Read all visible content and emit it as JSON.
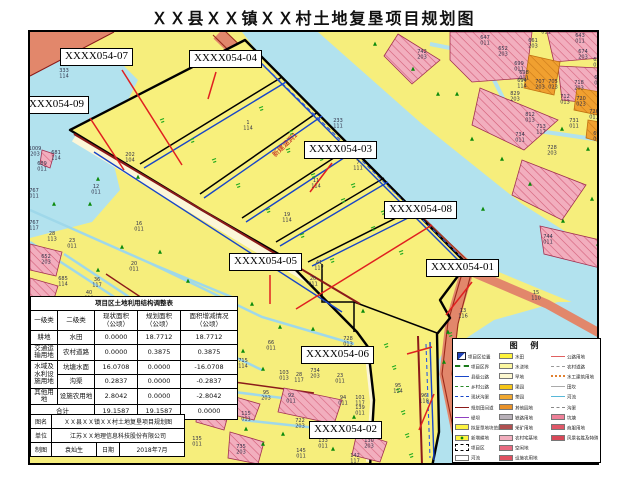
{
  "title": "ＸＸ县ＸＸ镇ＸＸ村土地复垦项目规划图",
  "palette": {
    "farmland_yellow": "#f6ee7c",
    "water_blue": "#b2e2ee",
    "road_salmon": "#e2876b",
    "road_edge_maroon": "#8b1a1a",
    "village_pink": "#f2aebe",
    "orchard_orange": "#f0a030",
    "canal_blue": "#1846c8",
    "leader_red": "#e02020",
    "tree_green": "#0b8a0b"
  },
  "map": {
    "culvert_note": {
      "text": "新建涵洞1",
      "x": 268,
      "y": 150
    },
    "plot_labels": [
      {
        "text": "XXXX054-07",
        "bx": 58,
        "by": 46,
        "x1": 120,
        "y1": 68,
        "x2": 180,
        "y2": 163
      },
      {
        "text": "XXXX054-04",
        "bx": 187,
        "by": 48,
        "x1": 214,
        "y1": 70,
        "x2": 206,
        "y2": 97
      },
      {
        "text": "XXXX054-09",
        "bx": 14,
        "by": 94,
        "x1": 88,
        "y1": 116,
        "x2": 122,
        "y2": 168
      },
      {
        "text": "XXXX054-03",
        "bx": 302,
        "by": 139,
        "x1": 330,
        "y1": 161,
        "x2": 308,
        "y2": 190
      },
      {
        "text": "XXXX054-08",
        "bx": 382,
        "by": 199,
        "x1": 430,
        "y1": 223,
        "x2": 294,
        "y2": 307
      },
      {
        "text": "XXXX054-01",
        "bx": 424,
        "by": 257,
        "x1": 470,
        "y1": 280,
        "x2": 444,
        "y2": 313
      },
      {
        "text": "XXXX054-05",
        "bx": 227,
        "by": 251,
        "x1": 268,
        "y1": 273,
        "x2": 268,
        "y2": 302
      },
      {
        "text": "XXXX054-06",
        "bx": 299,
        "by": 344,
        "x1": 405,
        "y1": 352,
        "x2": 430,
        "y2": 345
      },
      {
        "text": "XXXX054-02",
        "bx": 307,
        "by": 419,
        "x1": 417,
        "y1": 428,
        "x2": 432,
        "y2": 392
      }
    ],
    "parcel_numbers": [
      [
        62,
        66,
        "333/114"
      ],
      [
        33,
        144,
        "1009/203"
      ],
      [
        54,
        148,
        "681/114"
      ],
      [
        40,
        159,
        "689/011"
      ],
      [
        32,
        186,
        "767/011"
      ],
      [
        94,
        182,
        "12/011"
      ],
      [
        32,
        218,
        "767/117"
      ],
      [
        50,
        229,
        "28/113"
      ],
      [
        70,
        236,
        "23/011"
      ],
      [
        137,
        219,
        "16/011"
      ],
      [
        132,
        259,
        "20/011"
      ],
      [
        44,
        252,
        "652/203"
      ],
      [
        61,
        274,
        "685/114"
      ],
      [
        95,
        275,
        "36/117"
      ],
      [
        87,
        288,
        "40/011"
      ],
      [
        128,
        150,
        "202/104"
      ],
      [
        246,
        118,
        "1/114"
      ],
      [
        356,
        158,
        "7/111"
      ],
      [
        314,
        176,
        "11/114"
      ],
      [
        285,
        210,
        "19/114"
      ],
      [
        317,
        258,
        "41/117"
      ],
      [
        311,
        274,
        "20/011"
      ],
      [
        336,
        116,
        "233/111"
      ],
      [
        420,
        47,
        "742/203"
      ],
      [
        483,
        33,
        "647/011"
      ],
      [
        501,
        44,
        "652/203"
      ],
      [
        531,
        36,
        "661/203"
      ],
      [
        544,
        22,
        "628/011"
      ],
      [
        578,
        31,
        "643/011"
      ],
      [
        581,
        47,
        "674/203"
      ],
      [
        596,
        55,
        "626/011"
      ],
      [
        517,
        59,
        "699/011"
      ],
      [
        522,
        68,
        "698/011"
      ],
      [
        520,
        76,
        "694/114"
      ],
      [
        538,
        77,
        "707/203"
      ],
      [
        551,
        77,
        "705/023"
      ],
      [
        577,
        78,
        "718/203"
      ],
      [
        597,
        73,
        "680/011"
      ],
      [
        563,
        92,
        "712/013"
      ],
      [
        579,
        94,
        "720/023"
      ],
      [
        513,
        89,
        "829/203"
      ],
      [
        528,
        110,
        "812/013"
      ],
      [
        539,
        122,
        "713/117"
      ],
      [
        592,
        107,
        "726/011"
      ],
      [
        572,
        116,
        "731/011"
      ],
      [
        518,
        130,
        "734/011"
      ],
      [
        550,
        143,
        "728/203"
      ],
      [
        596,
        129,
        "692/011"
      ],
      [
        546,
        232,
        "744/011"
      ],
      [
        346,
        334,
        "728/013"
      ],
      [
        269,
        338,
        "66/011"
      ],
      [
        241,
        356,
        "715/114"
      ],
      [
        282,
        368,
        "103/013"
      ],
      [
        297,
        370,
        "28/117"
      ],
      [
        313,
        366,
        "734/203"
      ],
      [
        338,
        371,
        "23/011"
      ],
      [
        264,
        388,
        "95/203"
      ],
      [
        289,
        391,
        "92/011"
      ],
      [
        341,
        393,
        "94/011"
      ],
      [
        358,
        393,
        "101/117"
      ],
      [
        358,
        403,
        "139/011"
      ],
      [
        396,
        381,
        "95/114"
      ],
      [
        422,
        391,
        "96/118"
      ],
      [
        244,
        409,
        "115/011"
      ],
      [
        298,
        416,
        "722/203"
      ],
      [
        321,
        436,
        "133/011"
      ],
      [
        367,
        436,
        "130/203"
      ],
      [
        299,
        446,
        "145/011"
      ],
      [
        353,
        451,
        "142/117"
      ],
      [
        239,
        442,
        "735/203"
      ],
      [
        195,
        434,
        "135/011"
      ],
      [
        214,
        382,
        "125/203"
      ],
      [
        534,
        288,
        "15/110"
      ],
      [
        461,
        306,
        "13/116"
      ]
    ],
    "trees": [
      [
        88,
        202
      ],
      [
        120,
        245
      ],
      [
        158,
        250
      ],
      [
        186,
        279
      ],
      [
        150,
        297
      ],
      [
        96,
        268
      ],
      [
        70,
        297
      ],
      [
        250,
        302
      ],
      [
        278,
        325
      ],
      [
        241,
        349
      ],
      [
        261,
        367
      ],
      [
        311,
        327
      ],
      [
        336,
        355
      ],
      [
        361,
        309
      ],
      [
        455,
        92
      ],
      [
        470,
        137
      ],
      [
        500,
        157
      ],
      [
        528,
        182
      ],
      [
        560,
        127
      ],
      [
        586,
        147
      ],
      [
        590,
        197
      ],
      [
        481,
        207
      ],
      [
        436,
        92
      ],
      [
        411,
        67
      ],
      [
        373,
        42
      ],
      [
        96,
        177
      ],
      [
        136,
        175
      ],
      [
        52,
        202
      ],
      [
        561,
        219
      ],
      [
        596,
        242
      ],
      [
        261,
        442
      ],
      [
        281,
        432
      ],
      [
        244,
        427
      ],
      [
        352,
        415
      ],
      [
        331,
        447
      ],
      [
        446,
        330
      ],
      [
        442,
        360
      ]
    ],
    "marks": [
      [
        190,
        138
      ],
      [
        212,
        158
      ],
      [
        236,
        183
      ],
      [
        266,
        208
      ],
      [
        300,
        233
      ],
      [
        330,
        258
      ],
      [
        286,
        148
      ],
      [
        311,
        173
      ],
      [
        341,
        198
      ],
      [
        371,
        226
      ],
      [
        399,
        250
      ],
      [
        259,
        106
      ],
      [
        289,
        130
      ],
      [
        319,
        156
      ],
      [
        351,
        183
      ],
      [
        381,
        210
      ],
      [
        160,
        118
      ],
      [
        384,
        343
      ],
      [
        392,
        365
      ],
      [
        396,
        388
      ],
      [
        401,
        410
      ],
      [
        405,
        433
      ],
      [
        409,
        453
      ],
      [
        448,
        332
      ]
    ]
  },
  "table": {
    "title": "项目区土地利用结构调整表",
    "headers": [
      "一级类",
      "二级类",
      "现状面积\n（公顷）",
      "规划面积\n（公顷）",
      "面积增减情况\n（公顷）"
    ],
    "rows": [
      {
        "c1": "耕地",
        "c2": "水田",
        "v1": "0.0000",
        "v2": "18.7712",
        "v3": "18.7712"
      },
      {
        "c1": "交通运输用地",
        "c2": "农村道路",
        "v1": "0.0000",
        "v2": "0.3875",
        "v3": "0.3875"
      },
      {
        "c1": "水域及水利设施用地",
        "c2": "坑塘水面",
        "v1": "16.0708",
        "v2": "0.0000",
        "v3": "-16.0708"
      },
      {
        "c2": "沟渠",
        "v1": "0.2837",
        "v2": "0.0000",
        "v3": "-0.2837"
      },
      {
        "c1": "其他用地",
        "c2": "设施农用地",
        "v1": "2.8042",
        "v2": "0.0000",
        "v3": "-2.8042"
      }
    ],
    "total": {
      "label": "合计",
      "v1": "19.1587",
      "v2": "19.1587",
      "v3": "0.0000"
    }
  },
  "title_block": {
    "name_label": "图名",
    "name_value": "ＸＸ县ＸＸ镇ＸＸ村土地复垦项目规划图",
    "unit_label": "单位",
    "unit_value": "江苏ＸＸ地理信息科技股份有限公司",
    "draw_label": "制图",
    "draw_value": "袁灿生",
    "date_label": "日期",
    "date_value": "2018年7月"
  },
  "legend": {
    "title": "图 例",
    "columns": [
      [
        {
          "sw": "cp",
          "c": "#2244bb",
          "label": "项目区位置"
        },
        {
          "sw": "dash2",
          "c": "#1a7a1a",
          "label": "项目区界"
        },
        {
          "sw": "line",
          "c": "#1846c8",
          "label": "县级公路"
        },
        {
          "sw": "dash",
          "c": "#2a8a2a",
          "label": "乡村公路"
        },
        {
          "sw": "dash",
          "c": "#1846c8",
          "label": "现状沟渠"
        },
        {
          "sw": "line",
          "c": "#8b1a1a",
          "label": "规划田间道"
        },
        {
          "sw": "line",
          "c": "#9040c0",
          "label": "堤坝"
        },
        {
          "sw": "rect",
          "c": "#fdf341",
          "label": "拟复垦地块范围"
        },
        {
          "sw": "rectdot",
          "c": "#fdf341",
          "label": "新增耕地"
        },
        {
          "sw": "dashrect",
          "c": "#000000",
          "label": "项目区"
        },
        {
          "sw": "rect",
          "c": "#ffffff",
          "label": "河流"
        }
      ],
      [
        {
          "sw": "rect",
          "c": "#fef33c",
          "label": "水田"
        },
        {
          "sw": "rect",
          "c": "#fcf7a0",
          "label": "水浇地"
        },
        {
          "sw": "rect",
          "c": "#fdf8d0",
          "label": "旱地"
        },
        {
          "sw": "rect",
          "c": "#f5c518",
          "label": "果园"
        },
        {
          "sw": "rect",
          "c": "#f0a830",
          "label": "茶园"
        },
        {
          "sw": "rect",
          "c": "#e8922a",
          "label": "其他园地"
        },
        {
          "sw": "rect",
          "c": "#b8b0b8",
          "label": "铁路用地"
        },
        {
          "sw": "rect",
          "c": "#b05050",
          "label": "采矿用地"
        },
        {
          "sw": "rect",
          "c": "#f2aebe",
          "label": "农村宅基地"
        },
        {
          "sw": "rect",
          "c": "#e86a80",
          "label": "空闲地"
        },
        {
          "sw": "rect",
          "c": "#e05060",
          "label": "设施农用地"
        }
      ],
      [
        {
          "sw": "line",
          "c": "#e06060",
          "label": "公路用地"
        },
        {
          "sw": "dash",
          "c": "#999999",
          "label": "农村道路"
        },
        {
          "sw": "dot",
          "c": "#e08030",
          "label": "水工建筑用地"
        },
        {
          "sw": "line",
          "c": "#aaaaaa",
          "label": "田坎"
        },
        {
          "sw": "line",
          "c": "#58b8d8",
          "label": "河流"
        },
        {
          "sw": "dash",
          "c": "#888888",
          "label": "沟渠"
        },
        {
          "sw": "rect",
          "c": "#ee8098",
          "label": "坑塘"
        },
        {
          "sw": "rect",
          "c": "#e05868",
          "label": "商服用地"
        },
        {
          "sw": "rect",
          "c": "#d84858",
          "label": "风景名胜及特殊用地"
        }
      ]
    ]
  }
}
